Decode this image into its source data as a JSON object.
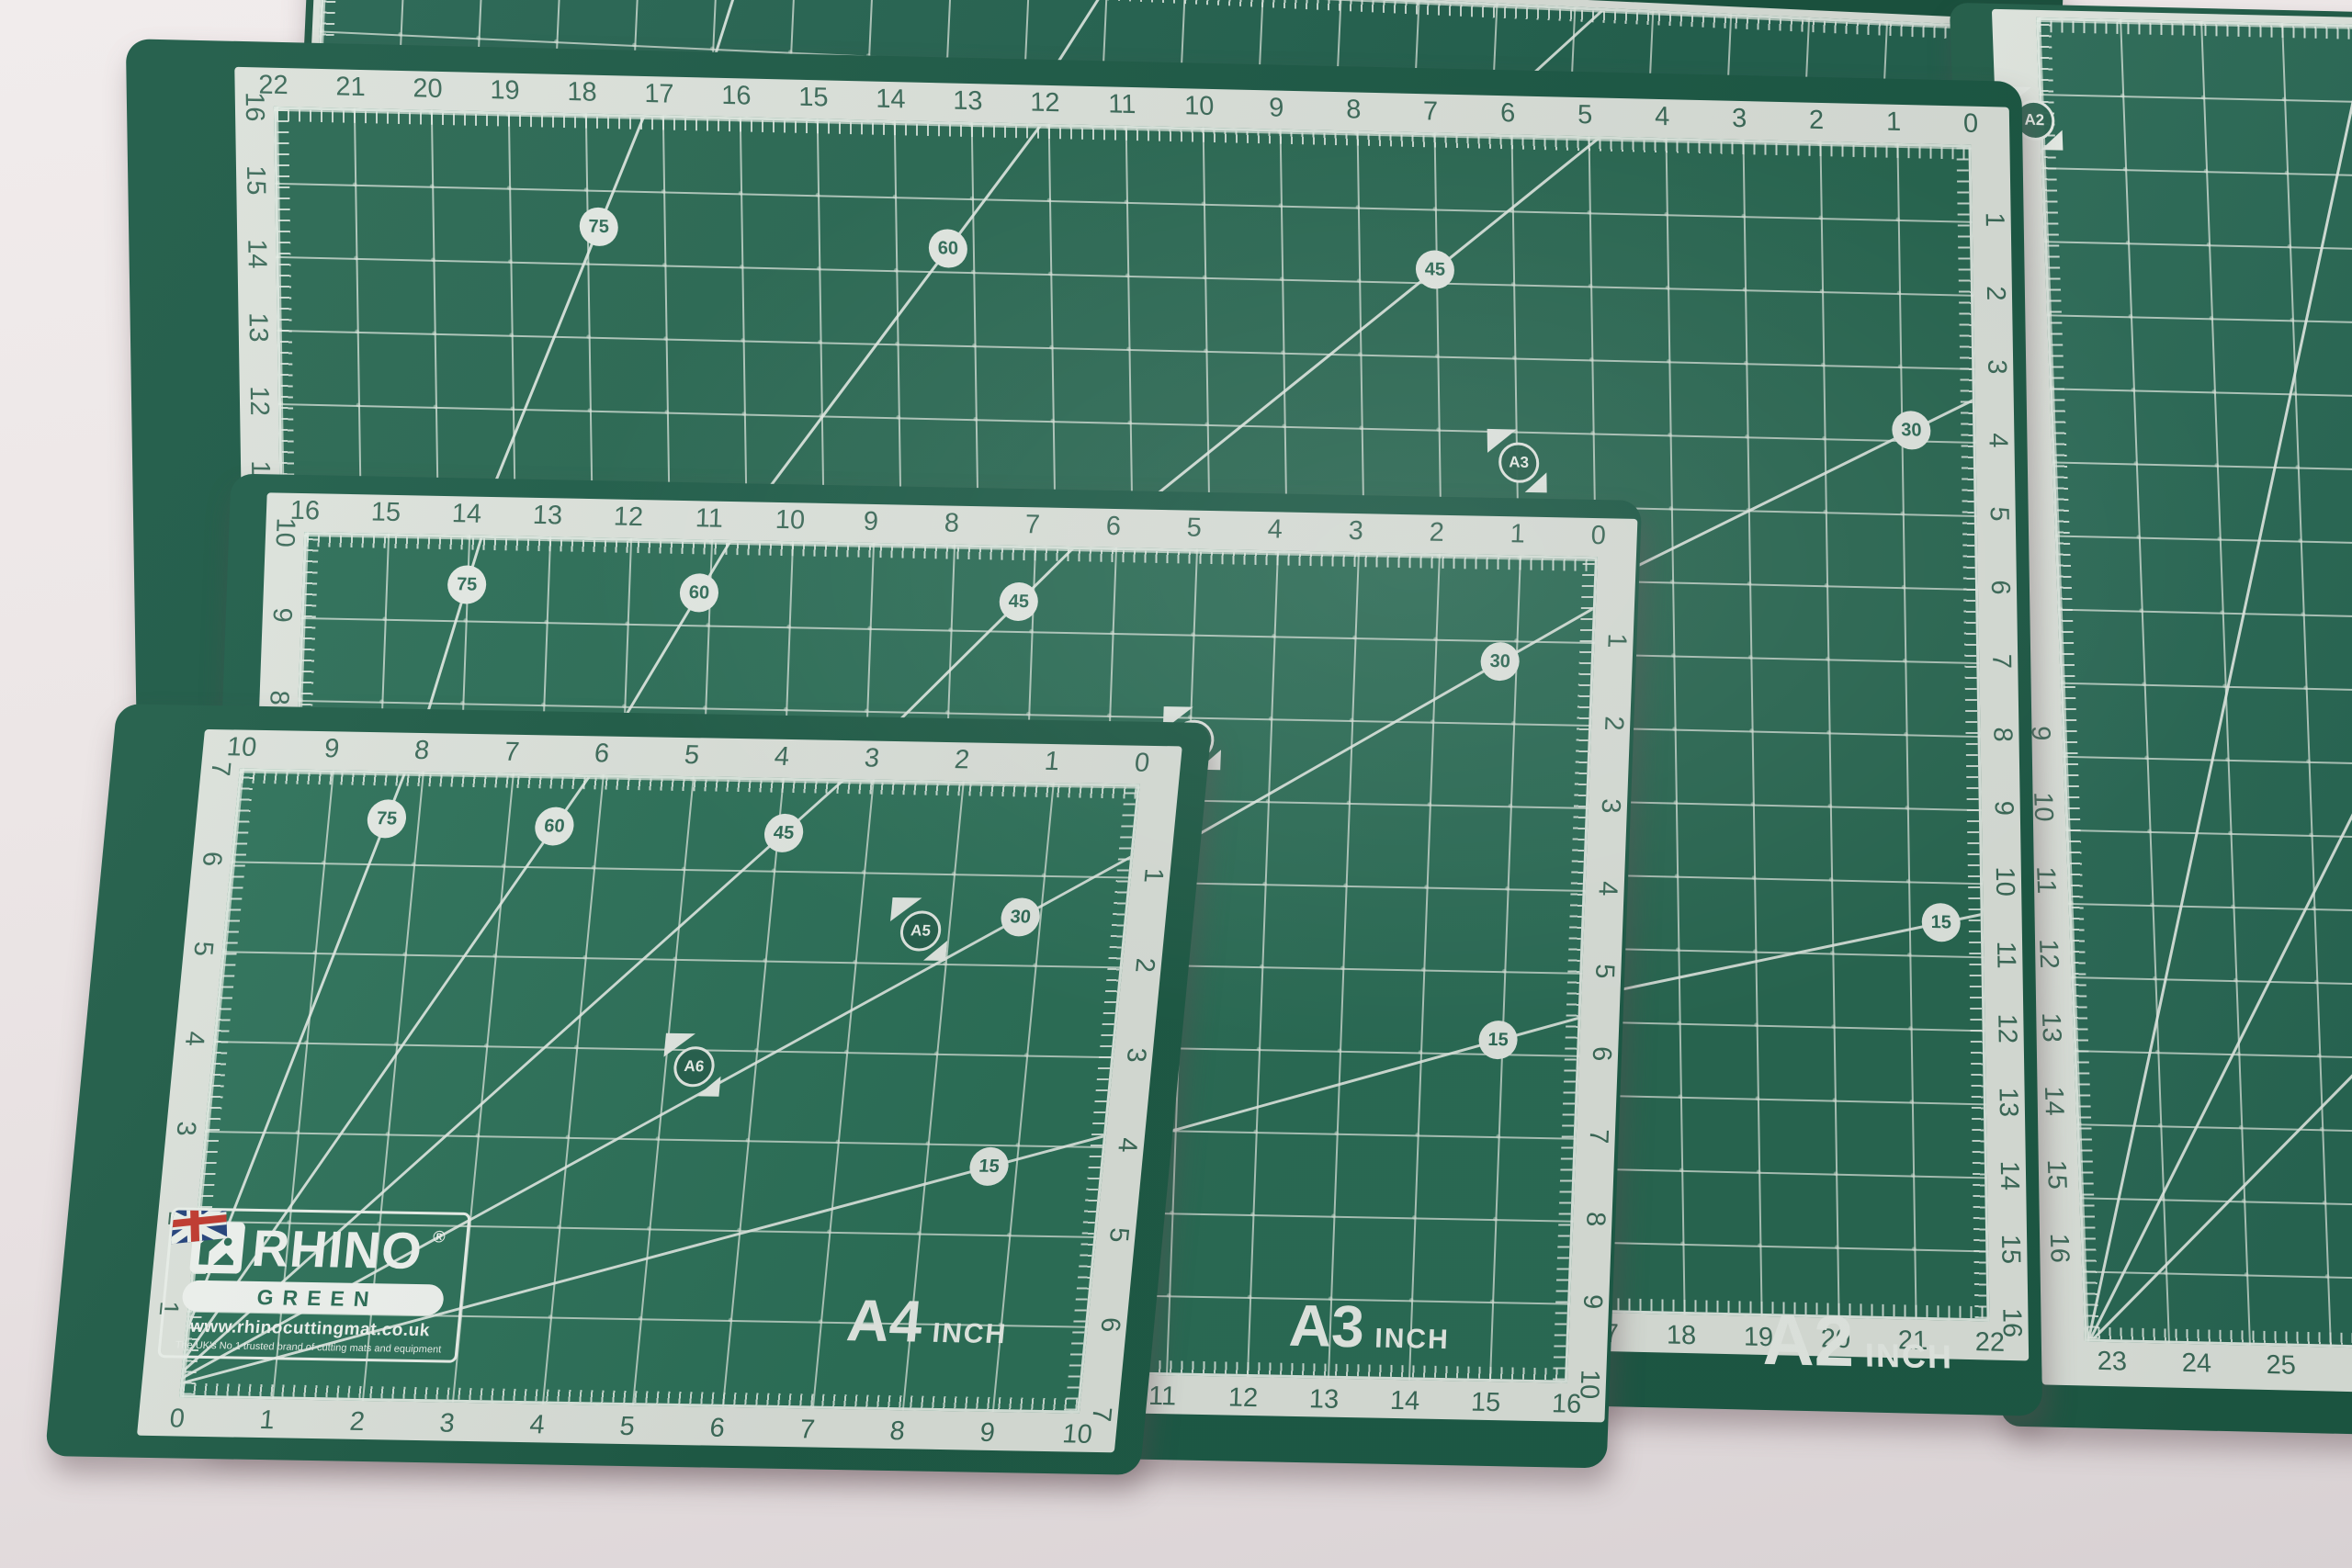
{
  "scene": {
    "description": "Overhead photo of four overlapping RHINO green self-healing cutting mats (A4, A3, A2 and a larger mat) on a pale pink table",
    "colors": {
      "surface": "#ece6e6",
      "mat_green": "#2b6d56",
      "mat_edge_green": "#1e5a46",
      "grid_line_white": "#d8e0d8",
      "ruler_strip": "#dbe1da",
      "ruler_number_green": "#3c6a59",
      "label_white": "#e5ebe5"
    }
  },
  "brand": {
    "name": "RHINO",
    "registered_mark": "®",
    "series": "GREEN",
    "website": "www.rhinocuttingmat.co.uk",
    "tagline": "The UK's No.1 trusted brand of cutting mats and equipment",
    "flag_icon": "uk-flag",
    "logo_icon": "rhino-icon"
  },
  "mats": [
    {
      "id": "a1-top",
      "name": "large background mat - top edge",
      "rulers": {},
      "angle_markers": [],
      "corner_markers": []
    },
    {
      "id": "a1-right",
      "name": "large background mat - right side",
      "rulers": {
        "left": {
          "values": [
            "9",
            "10",
            "11",
            "12",
            "13",
            "14",
            "15",
            "16"
          ]
        },
        "bottom": {
          "values": [
            "20",
            "21",
            "22",
            "23",
            "24",
            "25"
          ]
        }
      },
      "angle_markers": [],
      "corner_markers": [
        "A2"
      ]
    },
    {
      "id": "a2",
      "name": "A2 cutting mat",
      "label": {
        "size": "A2",
        "unit": "INCH"
      },
      "rulers": {
        "top": {
          "values": [
            "22",
            "21",
            "20",
            "19",
            "18",
            "17",
            "16",
            "15",
            "14",
            "13",
            "12",
            "11",
            "10",
            "9",
            "8",
            "7",
            "6",
            "5",
            "4",
            "3",
            "2",
            "1",
            "0"
          ]
        },
        "bottom": {
          "values": [
            "0",
            "1",
            "2",
            "3",
            "4",
            "5",
            "6",
            "7",
            "8",
            "9",
            "10",
            "11",
            "12",
            "13",
            "14",
            "15",
            "16",
            "17",
            "18",
            "19",
            "20",
            "21",
            "22"
          ]
        },
        "left": {
          "values": [
            "16",
            "15",
            "14",
            "13",
            "12",
            "11",
            "10",
            "9",
            "8",
            "7",
            "6",
            "5",
            "4",
            "3",
            "2",
            "1"
          ]
        },
        "right": {
          "values": [
            "1",
            "2",
            "3",
            "4",
            "5",
            "6",
            "7",
            "8",
            "9",
            "10",
            "11",
            "12",
            "13",
            "14",
            "15",
            "16"
          ]
        }
      },
      "angle_markers": [
        "75",
        "60",
        "45",
        "30",
        "15"
      ],
      "corner_markers": [
        "A3"
      ]
    },
    {
      "id": "a3",
      "name": "A3 cutting mat",
      "label": {
        "size": "A3",
        "unit": "INCH"
      },
      "rulers": {
        "top": {
          "values": [
            "16",
            "15",
            "14",
            "13",
            "12",
            "11",
            "10",
            "9",
            "8",
            "7",
            "6",
            "5",
            "4",
            "3",
            "2",
            "1",
            "0"
          ]
        },
        "bottom": {
          "values": [
            "0",
            "1",
            "2",
            "3",
            "4",
            "5",
            "6",
            "7",
            "8",
            "9",
            "10",
            "11",
            "12",
            "13",
            "14",
            "15",
            "16"
          ]
        },
        "left": {
          "values": [
            "10",
            "9",
            "8",
            "7",
            "6",
            "5",
            "4",
            "3",
            "2",
            "1"
          ]
        },
        "right": {
          "values": [
            "1",
            "2",
            "3",
            "4",
            "5",
            "6",
            "7",
            "8",
            "9",
            "10"
          ]
        }
      },
      "angle_markers": [
        "75",
        "60",
        "45",
        "30",
        "15"
      ],
      "corner_markers": [
        "A4"
      ]
    },
    {
      "id": "a4",
      "name": "A4 cutting mat",
      "label": {
        "size": "A4",
        "unit": "INCH"
      },
      "rulers": {
        "top": {
          "values": [
            "10",
            "9",
            "8",
            "7",
            "6",
            "5",
            "4",
            "3",
            "2",
            "1",
            "0"
          ]
        },
        "bottom": {
          "values": [
            "0",
            "1",
            "2",
            "3",
            "4",
            "5",
            "6",
            "7",
            "8",
            "9",
            "10"
          ]
        },
        "left": {
          "values": [
            "7",
            "6",
            "5",
            "4",
            "3",
            "2",
            "1"
          ]
        },
        "right": {
          "values": [
            "1",
            "2",
            "3",
            "4",
            "5",
            "6",
            "7"
          ]
        }
      },
      "angle_markers": [
        "75",
        "60",
        "45",
        "30",
        "15"
      ],
      "corner_markers": [
        "A5",
        "A6"
      ]
    }
  ]
}
